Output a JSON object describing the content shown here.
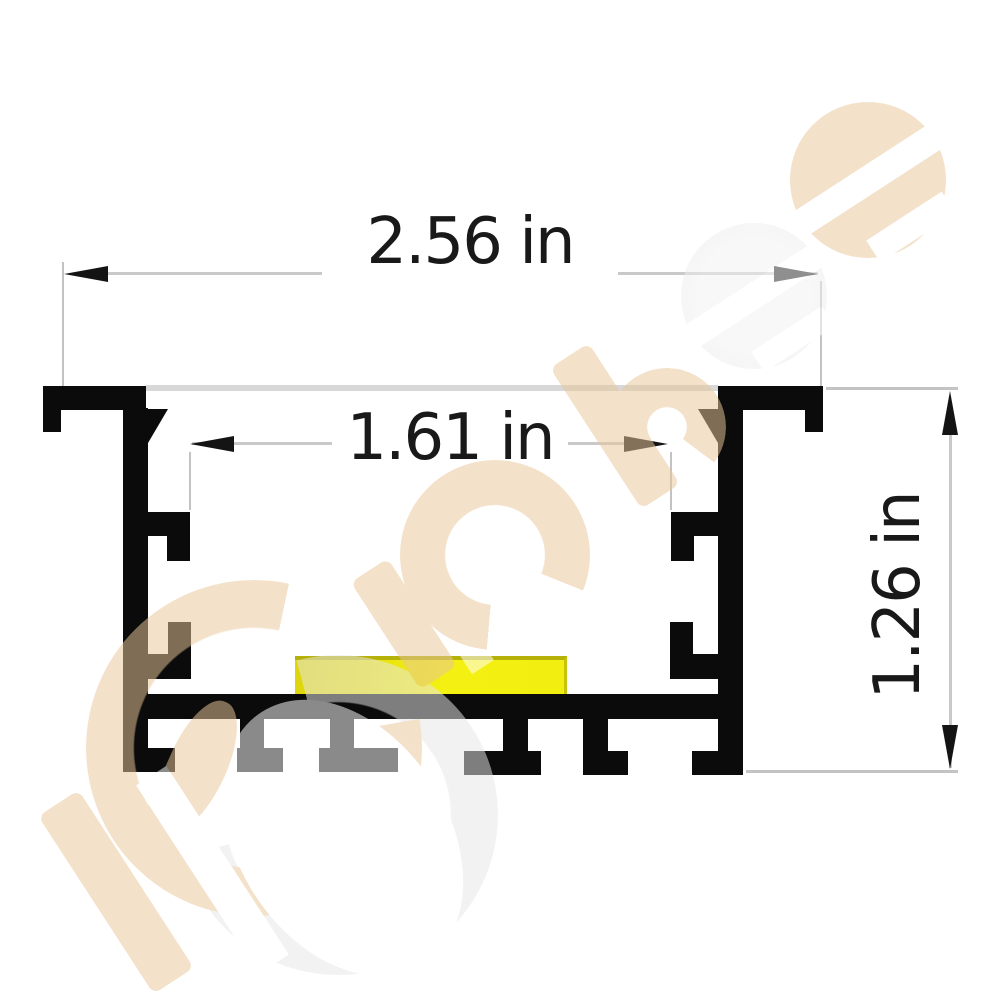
{
  "title": "Recessed LED aluminum profile cross-section drawing",
  "dimensions": {
    "outer_width": {
      "label": "2.56 in"
    },
    "inner_width": {
      "label": "1.61 in"
    },
    "height": {
      "label": "1.26 in"
    }
  },
  "drawing": {
    "profile_color": "#0b0b0b",
    "led_strip_color": "#f2ee10",
    "dimension_line_color": "#c9c9c9",
    "dimension_text_color": "#191919",
    "lens_line_color": "#d8d8d8"
  },
  "watermark": {
    "tan_color": "#e9c79a",
    "gray_color": "#e7e7e7",
    "elements": [
      "swoosh-c-icon",
      "letter-p-bar-icon",
      "letter-i-bar-icon",
      "letter-c-ring-icon",
      "letter-h-icon",
      "e-disc-gray-icon",
      "e-disc-tan-icon"
    ]
  }
}
